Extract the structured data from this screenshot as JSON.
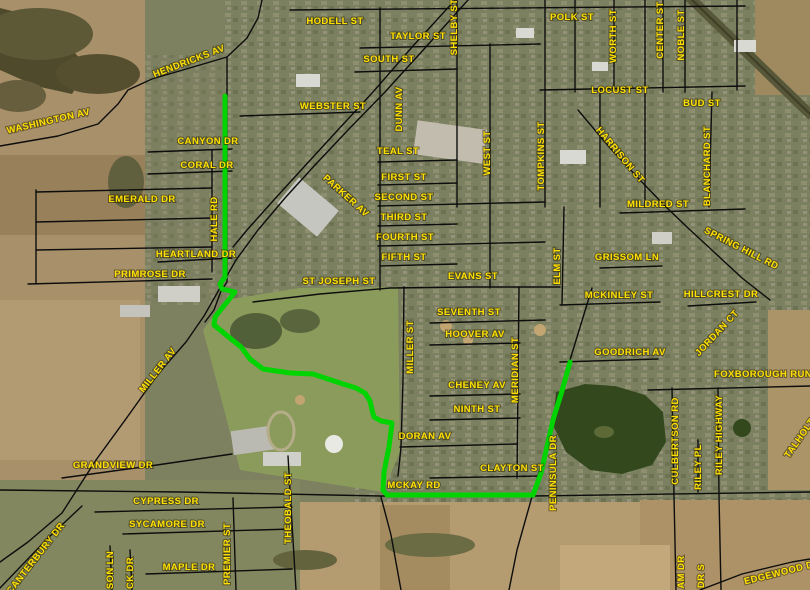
{
  "map": {
    "type": "aerial-gis-map",
    "label_color": "#ffe000",
    "road_color": "#0d0d0d",
    "road_width": 1.4,
    "route": {
      "color": "#00d400",
      "width": 5,
      "points": "225,96 225,277 220,284 222,289 235,292 215,317 214,325 241,347 250,359 263,369 290,373 313,374 322,377 340,383 356,388 365,393 370,401 372,410 374,417 381,421 392,423 389,447 384,472 383,490 387,495 533,495 541,473 553,420 562,391 570,362"
    },
    "roads": [
      "0,146 58,136 98,124 118,104 128,90 152,79 193,67 227,57 247,38 258,18 262,0",
      "227,57 227,282 221,291 214,310 205,322",
      "468,0 425,48 385,92 348,130 315,165 285,198 258,230 236,260 220,288 204,316 186,342 158,374 128,416 96,460 62,513 28,542 0,562",
      "455,0 413,46 373,92 336,132 303,168 272,202 247,230 233,247",
      "0,490 180,492 380,496 533,496 810,492",
      "253,302 320,294 390,288 470,287 560,287",
      "592,288 570,360 546,448 533,493 517,550 509,590",
      "578,110 610,148 640,180 664,205 688,228 714,252 742,278 770,300",
      "380,8 380,290",
      "404,287 403,380 401,447 398,476",
      "381,497 391,535 401,590",
      "457,0 457,207",
      "490,44 490,288",
      "519,287 517,478",
      "545,0 545,207",
      "564,207 562,305",
      "600,90 600,207",
      "614,0 614,90",
      "645,0 645,207",
      "663,0 663,92",
      "685,0 685,92",
      "712,92 709,207",
      "737,0 737,90",
      "575,0 575,92",
      "290,10 745,6",
      "360,48 540,44",
      "355,72 457,69",
      "540,90 745,86",
      "240,116 360,112",
      "378,162 457,160",
      "378,185 457,183",
      "378,206 545,202",
      "378,226 457,224",
      "378,246 545,242",
      "380,266 457,264",
      "430,323 545,320",
      "430,345 520,343",
      "430,396 520,394",
      "430,420 520,418",
      "400,447 517,444",
      "430,478 540,476",
      "620,213 745,209",
      "600,268 662,266",
      "560,305 660,302",
      "560,362 658,359",
      "688,306 756,302",
      "648,390 810,386",
      "672,388 674,496 676,590",
      "718,388 719,496 721,590",
      "698,440 698,492",
      "62,478 150,466 232,454",
      "95,512 292,507",
      "123,534 292,529",
      "146,574 292,569",
      "233,498 236,590",
      "288,456 296,590",
      "0,588 48,538 82,506",
      "110,546 112,590",
      "130,550 132,590",
      "36,192 212,188",
      "36,222 212,218",
      "36,250 212,247",
      "36,190 36,284",
      "212,150 212,272",
      "148,152 232,149",
      "148,174 232,171",
      "158,262 232,258",
      "28,284 212,279",
      "700,590 742,574 792,562 810,559"
    ],
    "labels": [
      {
        "text": "WASHINGTON AV",
        "x": 49,
        "y": 124,
        "rot": -13
      },
      {
        "text": "HENDRICKS AV",
        "x": 190,
        "y": 64,
        "rot": -21
      },
      {
        "text": "HODELL ST",
        "x": 335,
        "y": 24,
        "rot": 0
      },
      {
        "text": "TAYLOR ST",
        "x": 418,
        "y": 39,
        "rot": 0
      },
      {
        "text": "SHELBY ST",
        "x": 457,
        "y": 27,
        "rot": -90
      },
      {
        "text": "SOUTH ST",
        "x": 389,
        "y": 62,
        "rot": 0
      },
      {
        "text": "WEBSTER ST",
        "x": 333,
        "y": 109,
        "rot": 0
      },
      {
        "text": "DUNN AV",
        "x": 402,
        "y": 109,
        "rot": -90
      },
      {
        "text": "POLK ST",
        "x": 572,
        "y": 20,
        "rot": 0
      },
      {
        "text": "WORTH ST",
        "x": 616,
        "y": 36,
        "rot": -90
      },
      {
        "text": "CENTER ST",
        "x": 663,
        "y": 30,
        "rot": -90
      },
      {
        "text": "NOBLE ST",
        "x": 684,
        "y": 35,
        "rot": -90
      },
      {
        "text": "LOCUST ST",
        "x": 620,
        "y": 93,
        "rot": 0
      },
      {
        "text": "BUD ST",
        "x": 702,
        "y": 106,
        "rot": 0
      },
      {
        "text": "CANYON DR",
        "x": 208,
        "y": 144,
        "rot": 0
      },
      {
        "text": "CORAL DR",
        "x": 207,
        "y": 168,
        "rot": 0
      },
      {
        "text": "EMERALD DR",
        "x": 142,
        "y": 202,
        "rot": 0
      },
      {
        "text": "HALE RD",
        "x": 217,
        "y": 219,
        "rot": -90
      },
      {
        "text": "PARKER AV",
        "x": 344,
        "y": 198,
        "rot": 42
      },
      {
        "text": "MILDRED ST",
        "x": 658,
        "y": 207,
        "rot": 0
      },
      {
        "text": "BLANCHARD ST",
        "x": 710,
        "y": 166,
        "rot": -90
      },
      {
        "text": "HARRISON ST",
        "x": 618,
        "y": 157,
        "rot": 50
      },
      {
        "text": "TOMPKINS ST",
        "x": 544,
        "y": 156,
        "rot": -90
      },
      {
        "text": "WEST ST",
        "x": 490,
        "y": 153,
        "rot": -90
      },
      {
        "text": "TEAL ST",
        "x": 398,
        "y": 154,
        "rot": 0
      },
      {
        "text": "FIRST ST",
        "x": 404,
        "y": 180,
        "rot": 0
      },
      {
        "text": "SECOND ST",
        "x": 404,
        "y": 200,
        "rot": 0
      },
      {
        "text": "THIRD ST",
        "x": 404,
        "y": 220,
        "rot": 0
      },
      {
        "text": "FOURTH ST",
        "x": 405,
        "y": 240,
        "rot": 0
      },
      {
        "text": "FIFTH ST",
        "x": 404,
        "y": 260,
        "rot": 0
      },
      {
        "text": "HEARTLAND DR",
        "x": 196,
        "y": 257,
        "rot": 0
      },
      {
        "text": "PRIMROSE DR",
        "x": 150,
        "y": 277,
        "rot": 0
      },
      {
        "text": "ST JOSEPH ST",
        "x": 339,
        "y": 284,
        "rot": 0
      },
      {
        "text": "EVANS ST",
        "x": 473,
        "y": 279,
        "rot": 0
      },
      {
        "text": "ELM ST",
        "x": 560,
        "y": 266,
        "rot": -90
      },
      {
        "text": "GRISSOM LN",
        "x": 627,
        "y": 260,
        "rot": 0
      },
      {
        "text": "SPRING HILL RD",
        "x": 740,
        "y": 251,
        "rot": 27
      },
      {
        "text": "MCKINLEY ST",
        "x": 619,
        "y": 298,
        "rot": 0
      },
      {
        "text": "HILLCREST DR",
        "x": 721,
        "y": 297,
        "rot": 0
      },
      {
        "text": "SEVENTH ST",
        "x": 469,
        "y": 315,
        "rot": 0
      },
      {
        "text": "HOOVER AV",
        "x": 475,
        "y": 337,
        "rot": 0
      },
      {
        "text": "MILLER ST",
        "x": 413,
        "y": 347,
        "rot": -90
      },
      {
        "text": "MERIDIAN ST",
        "x": 518,
        "y": 370,
        "rot": -90
      },
      {
        "text": "JORDAN CT",
        "x": 719,
        "y": 335,
        "rot": -47
      },
      {
        "text": "GOODRICH AV",
        "x": 630,
        "y": 355,
        "rot": 0
      },
      {
        "text": "MILLER AV",
        "x": 160,
        "y": 372,
        "rot": -52
      },
      {
        "text": "CHENEY AV",
        "x": 477,
        "y": 388,
        "rot": 0
      },
      {
        "text": "FOXBOROUGH RUN",
        "x": 763,
        "y": 377,
        "rot": 0
      },
      {
        "text": "NINTH ST",
        "x": 477,
        "y": 412,
        "rot": 0
      },
      {
        "text": "DORAN AV",
        "x": 425,
        "y": 439,
        "rot": 0
      },
      {
        "text": "GRANDVIEW DR",
        "x": 113,
        "y": 468,
        "rot": 0
      },
      {
        "text": "CLAYTON ST",
        "x": 512,
        "y": 471,
        "rot": 0
      },
      {
        "text": "MCKAY RD",
        "x": 414,
        "y": 488,
        "rot": 0
      },
      {
        "text": "PENINSULA DR",
        "x": 556,
        "y": 473,
        "rot": -90
      },
      {
        "text": "CULBERTSON RD",
        "x": 678,
        "y": 441,
        "rot": -90
      },
      {
        "text": "RILEY PL",
        "x": 701,
        "y": 467,
        "rot": -90
      },
      {
        "text": "RILEY HIGHWAY",
        "x": 722,
        "y": 435,
        "rot": -90
      },
      {
        "text": "TALHOLT",
        "x": 802,
        "y": 440,
        "rot": -55
      },
      {
        "text": "CYPRESS DR",
        "x": 166,
        "y": 504,
        "rot": 0
      },
      {
        "text": "SYCAMORE DR",
        "x": 167,
        "y": 527,
        "rot": 0
      },
      {
        "text": "CANTERBURY DR",
        "x": 38,
        "y": 560,
        "rot": -52
      },
      {
        "text": "MAPLE DR",
        "x": 189,
        "y": 570,
        "rot": 0
      },
      {
        "text": "PREMIER ST",
        "x": 230,
        "y": 554,
        "rot": -90
      },
      {
        "text": "THEOBALD ST",
        "x": 291,
        "y": 508,
        "rot": -90
      },
      {
        "text": "SON LN",
        "x": 113,
        "y": 570,
        "rot": -90
      },
      {
        "text": "CK DR",
        "x": 133,
        "y": 573,
        "rot": -90
      },
      {
        "text": "AM DR",
        "x": 684,
        "y": 572,
        "rot": -90
      },
      {
        "text": "DR S",
        "x": 704,
        "y": 576,
        "rot": -90
      },
      {
        "text": "EDGEWOOD DR",
        "x": 783,
        "y": 575,
        "rot": -14
      }
    ]
  }
}
